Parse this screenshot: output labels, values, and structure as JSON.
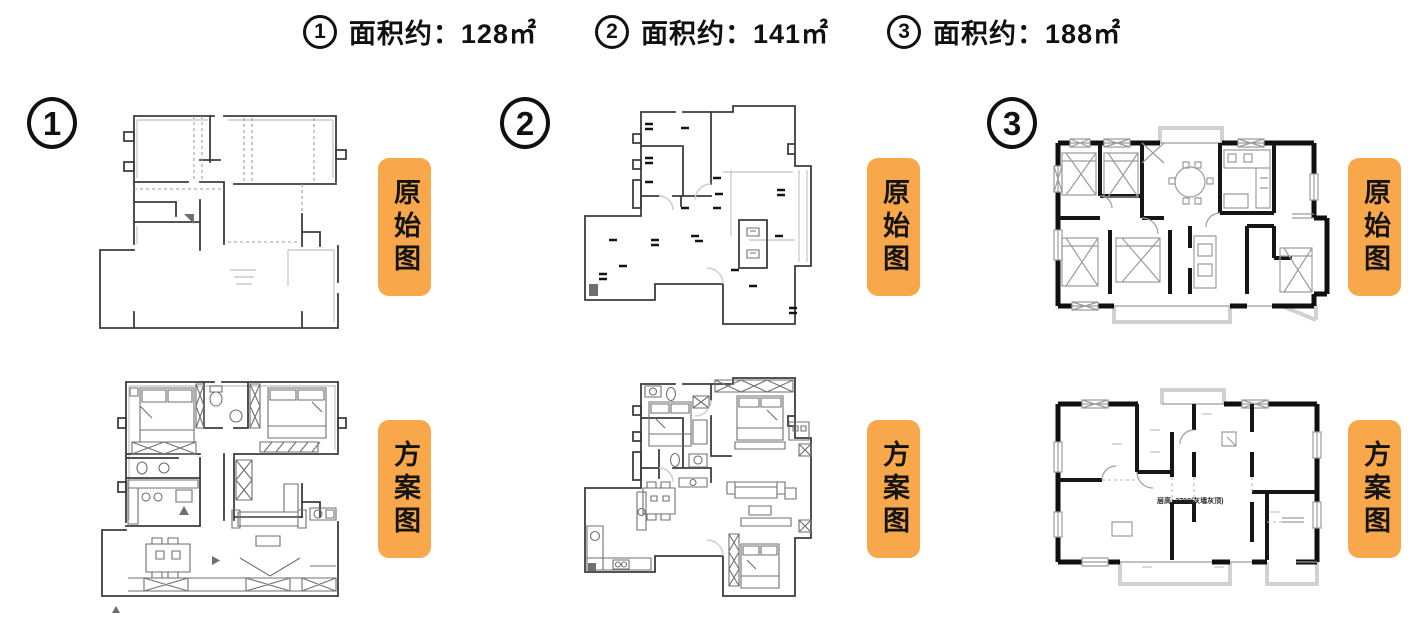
{
  "page": {
    "background": "#ffffff"
  },
  "colors": {
    "tag_bg": "#F8A74B",
    "tag_text": "#141414",
    "ink": "#111111",
    "wall_dark": "#3d3d3d",
    "wall_black": "#0f0f0f",
    "wall_light": "#cccccc"
  },
  "header": {
    "items": [
      {
        "number": "1",
        "area_label": "面积约：128㎡"
      },
      {
        "number": "2",
        "area_label": "面积约：141㎡"
      },
      {
        "number": "3",
        "area_label": "面积约：188㎡"
      }
    ]
  },
  "columns": [
    {
      "number": "1",
      "original_tag": "原始图",
      "scheme_tag": "方案图"
    },
    {
      "number": "2",
      "original_tag": "原始图",
      "scheme_tag": "方案图"
    },
    {
      "number": "3",
      "original_tag": "原始图",
      "scheme_tag": "方案图"
    }
  ],
  "plan_annotations": {
    "plan3_scheme_note": "层高: 2780(灰墙灰顶)"
  }
}
